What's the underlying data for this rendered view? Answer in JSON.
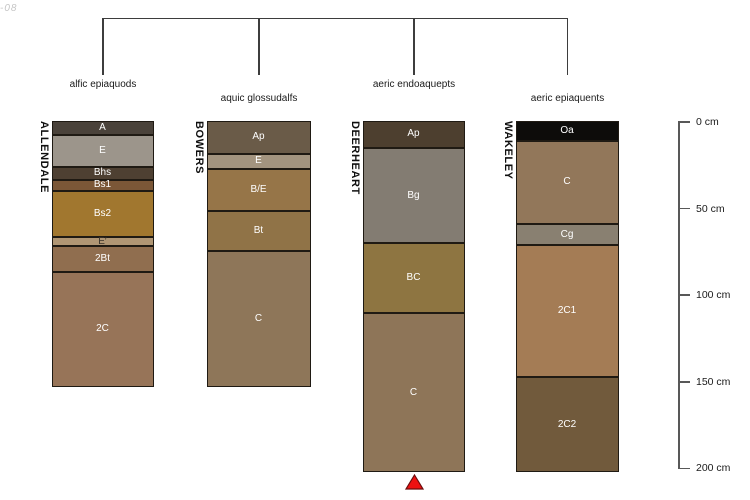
{
  "page": {
    "corner_fragment": "-08",
    "background": "#ffffff"
  },
  "chart_data": {
    "type": "soil-profile-columns",
    "depth_scale": {
      "unit": "cm",
      "min": 0,
      "max": 200,
      "ticks": [
        0,
        50,
        100,
        150,
        200
      ],
      "tick_labels": [
        "0 cm",
        "50 cm",
        "100 cm",
        "150 cm",
        "200 cm"
      ],
      "position": "right"
    },
    "classification_labels": [
      "alfic epiaquods",
      "aquic glossudalfs",
      "aeric endoaquepts",
      "aeric epiaquents"
    ],
    "profiles": [
      {
        "series": "ALLENDALE",
        "classification": "alfic epiaquods",
        "horizons": [
          {
            "name": "A",
            "top_cm": 0,
            "bottom_cm": 7.5,
            "color": "#4a423a",
            "label_color": "#ffffff"
          },
          {
            "name": "E",
            "top_cm": 7.5,
            "bottom_cm": 25.5,
            "color": "#9c958b",
            "label_color": "#ffffff"
          },
          {
            "name": "Bhs",
            "top_cm": 25.5,
            "bottom_cm": 33,
            "color": "#4e4032",
            "label_color": "#ffffff"
          },
          {
            "name": "Bs1",
            "top_cm": 33,
            "bottom_cm": 39.5,
            "color": "#7b5737",
            "label_color": "#ffffff"
          },
          {
            "name": "Bs2",
            "top_cm": 39.5,
            "bottom_cm": 66,
            "color": "#a1772f",
            "label_color": "#ffffff"
          },
          {
            "name": "E′",
            "top_cm": 66,
            "bottom_cm": 71.5,
            "color": "#b09674",
            "label_color": "#3a332a"
          },
          {
            "name": "2Bt",
            "top_cm": 71.5,
            "bottom_cm": 86.5,
            "color": "#906e4f",
            "label_color": "#ffffff"
          },
          {
            "name": "2C",
            "top_cm": 86.5,
            "bottom_cm": 152.5,
            "color": "#977458",
            "label_color": "#ffffff"
          }
        ]
      },
      {
        "series": "BOWERS",
        "classification": "aquic glossudalfs",
        "horizons": [
          {
            "name": "Ap",
            "top_cm": 0,
            "bottom_cm": 18,
            "color": "#6a5b48",
            "label_color": "#ffffff"
          },
          {
            "name": "E",
            "top_cm": 18,
            "bottom_cm": 27,
            "color": "#a3947f",
            "label_color": "#ffffff"
          },
          {
            "name": "B/E",
            "top_cm": 27,
            "bottom_cm": 51,
            "color": "#967548",
            "label_color": "#ffffff"
          },
          {
            "name": "Bt",
            "top_cm": 51,
            "bottom_cm": 74,
            "color": "#907347",
            "label_color": "#ffffff"
          },
          {
            "name": "C",
            "top_cm": 74,
            "bottom_cm": 152.5,
            "color": "#8e7659",
            "label_color": "#ffffff"
          }
        ]
      },
      {
        "series": "DEERHEART",
        "classification": "aeric endoaquepts",
        "horizons": [
          {
            "name": "Ap",
            "top_cm": 0,
            "bottom_cm": 15,
            "color": "#4d3f2f",
            "label_color": "#ffffff"
          },
          {
            "name": "Bg",
            "top_cm": 15,
            "bottom_cm": 69.5,
            "color": "#837c72",
            "label_color": "#ffffff"
          },
          {
            "name": "BC",
            "top_cm": 69.5,
            "bottom_cm": 110,
            "color": "#8e7541",
            "label_color": "#ffffff"
          },
          {
            "name": "C",
            "top_cm": 110,
            "bottom_cm": 202,
            "color": "#8e7558",
            "label_color": "#ffffff"
          }
        ]
      },
      {
        "series": "WAKELEY",
        "classification": "aeric epiaquents",
        "horizons": [
          {
            "name": "Oa",
            "top_cm": 0,
            "bottom_cm": 10.5,
            "color": "#0d0c0a",
            "label_color": "#ffffff"
          },
          {
            "name": "C",
            "top_cm": 10.5,
            "bottom_cm": 58.5,
            "color": "#92775a",
            "label_color": "#ffffff"
          },
          {
            "name": "Cg",
            "top_cm": 58.5,
            "bottom_cm": 71,
            "color": "#898071",
            "label_color": "#ffffff"
          },
          {
            "name": "2C1",
            "top_cm": 71,
            "bottom_cm": 147,
            "color": "#a47c55",
            "label_color": "#ffffff"
          },
          {
            "name": "2C2",
            "top_cm": 147,
            "bottom_cm": 202,
            "color": "#715a3c",
            "label_color": "#ffffff"
          }
        ]
      }
    ],
    "marker": {
      "shape": "triangle-up",
      "fill": "#ee1111",
      "outline": "#6b0d0d",
      "below_profile": "DEERHEART"
    }
  }
}
